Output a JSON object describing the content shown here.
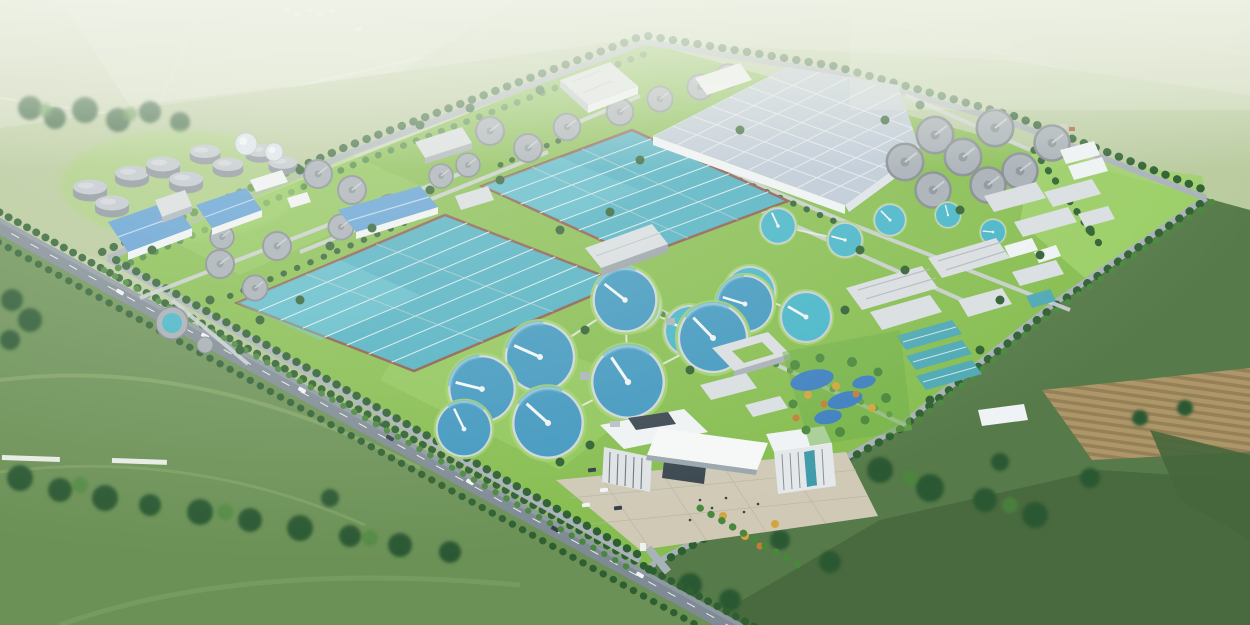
{
  "meta": {
    "type": "architectural-aerial-rendering",
    "subject": "Large wastewater treatment plant campus, bird's-eye perspective rendering",
    "view": "oblique aerial from south, hazy atmosphere toward horizon",
    "visible_text": "none"
  },
  "scene": {
    "site": {
      "shape": "tilted rectangular campus bounded by tree-lined roads",
      "features": {
        "aeration_basins": {
          "count": 2,
          "water_color_name": "teal",
          "lanes_per_basin": 8
        },
        "membrane_covered_facility": {
          "count": 1,
          "roof": "light blue-gray grid roof, white walls"
        },
        "open_clarifiers_blue": {
          "count": 8,
          "detail": "deep blue water, white radial bridge"
        },
        "open_clarifiers_teal": {
          "count": 9,
          "detail": "teal water, white radial bridge"
        },
        "covered_clarifiers_gray": {
          "count": 25
        },
        "digester_cylinders": {
          "count": 9
        },
        "spherical_gas_holders": {
          "count": 2
        },
        "blue_roof_warehouses": {
          "count": 3
        },
        "process_buildings_gray": {
          "count": 16
        },
        "teal_roof_buildings": {
          "count": 4
        },
        "admin_campus": {
          "buildings": 2,
          "plaza": "beige paved plaza with cars",
          "entrance": "south gate to highway"
        },
        "wetland_garden": {
          "ponds": 4,
          "trees": "green, yellow and orange ornamental trees"
        },
        "reserved_green_field": {
          "count": 1
        }
      }
    },
    "surroundings": {
      "highway": "dual-carriageway road with street trees running along the south-west edge",
      "boundary_roads": 4,
      "farmland": "pale hazy fields to the north, striped crop rows and tan tilled patch to the east, dark meadows and woods to the south",
      "pond_outside": 1,
      "village_houses": 5,
      "forest_bands": "dark tree masses along roads and field edges"
    }
  },
  "palette": {
    "skyTop": "#d8dfc9",
    "fieldPale": "#c9d3b2",
    "fieldLight": "#b7c99a",
    "fieldMid": "#93b274",
    "fieldOlive": "#8aa871",
    "fieldDark": "#567a49",
    "fieldDeep": "#46663c",
    "meadow": "#6b9156",
    "meadowLight": "#8fae6f",
    "dirtTan": "#ad9769",
    "dirtRow": "#8f7b52",
    "siteGrass": "#86bd4f",
    "siteGrassLight": "#9ed168",
    "treeDark": "#2d5f30",
    "treeMid": "#49883c",
    "treeLight": "#6fae49",
    "treeYellow": "#d2a53e",
    "treeOrange": "#c27e35",
    "forest": "#2b5831",
    "road": "#7e8a94",
    "roadLight": "#a9b2b9",
    "roadPath": "#ccd2d6",
    "laneLine": "#eef6f6",
    "basinWater": "#4fb0c2",
    "basinWaterLight": "#74cbd6",
    "basinRim": "#8a5a4a",
    "clarBlue": "#3f97bf",
    "clarTeal": "#45b5c8",
    "tankRim": "#c6cdd2",
    "covTank": "#a6aeb5",
    "covRim": "#82898f",
    "tankTop": "#c0c7ce",
    "tankSide": "#8b939b",
    "sphere": "#dde6ee",
    "roofBig": "#bdc9d7",
    "roofBlue": "#5f9fd4",
    "roofTeal": "#4da8b4",
    "wallWhite": "#f0f3f5",
    "wallGray": "#d9dee2",
    "glassDark": "#39454e",
    "glassTeal": "#3f9aa8",
    "plaza": "#cfc9b6",
    "plazaLine": "#b8b2a0",
    "pond": "#3d7fc0",
    "pondGray": "#6f8a85",
    "carDark": "#323a44",
    "white": "#ffffff",
    "haze": "#eef2e6"
  }
}
